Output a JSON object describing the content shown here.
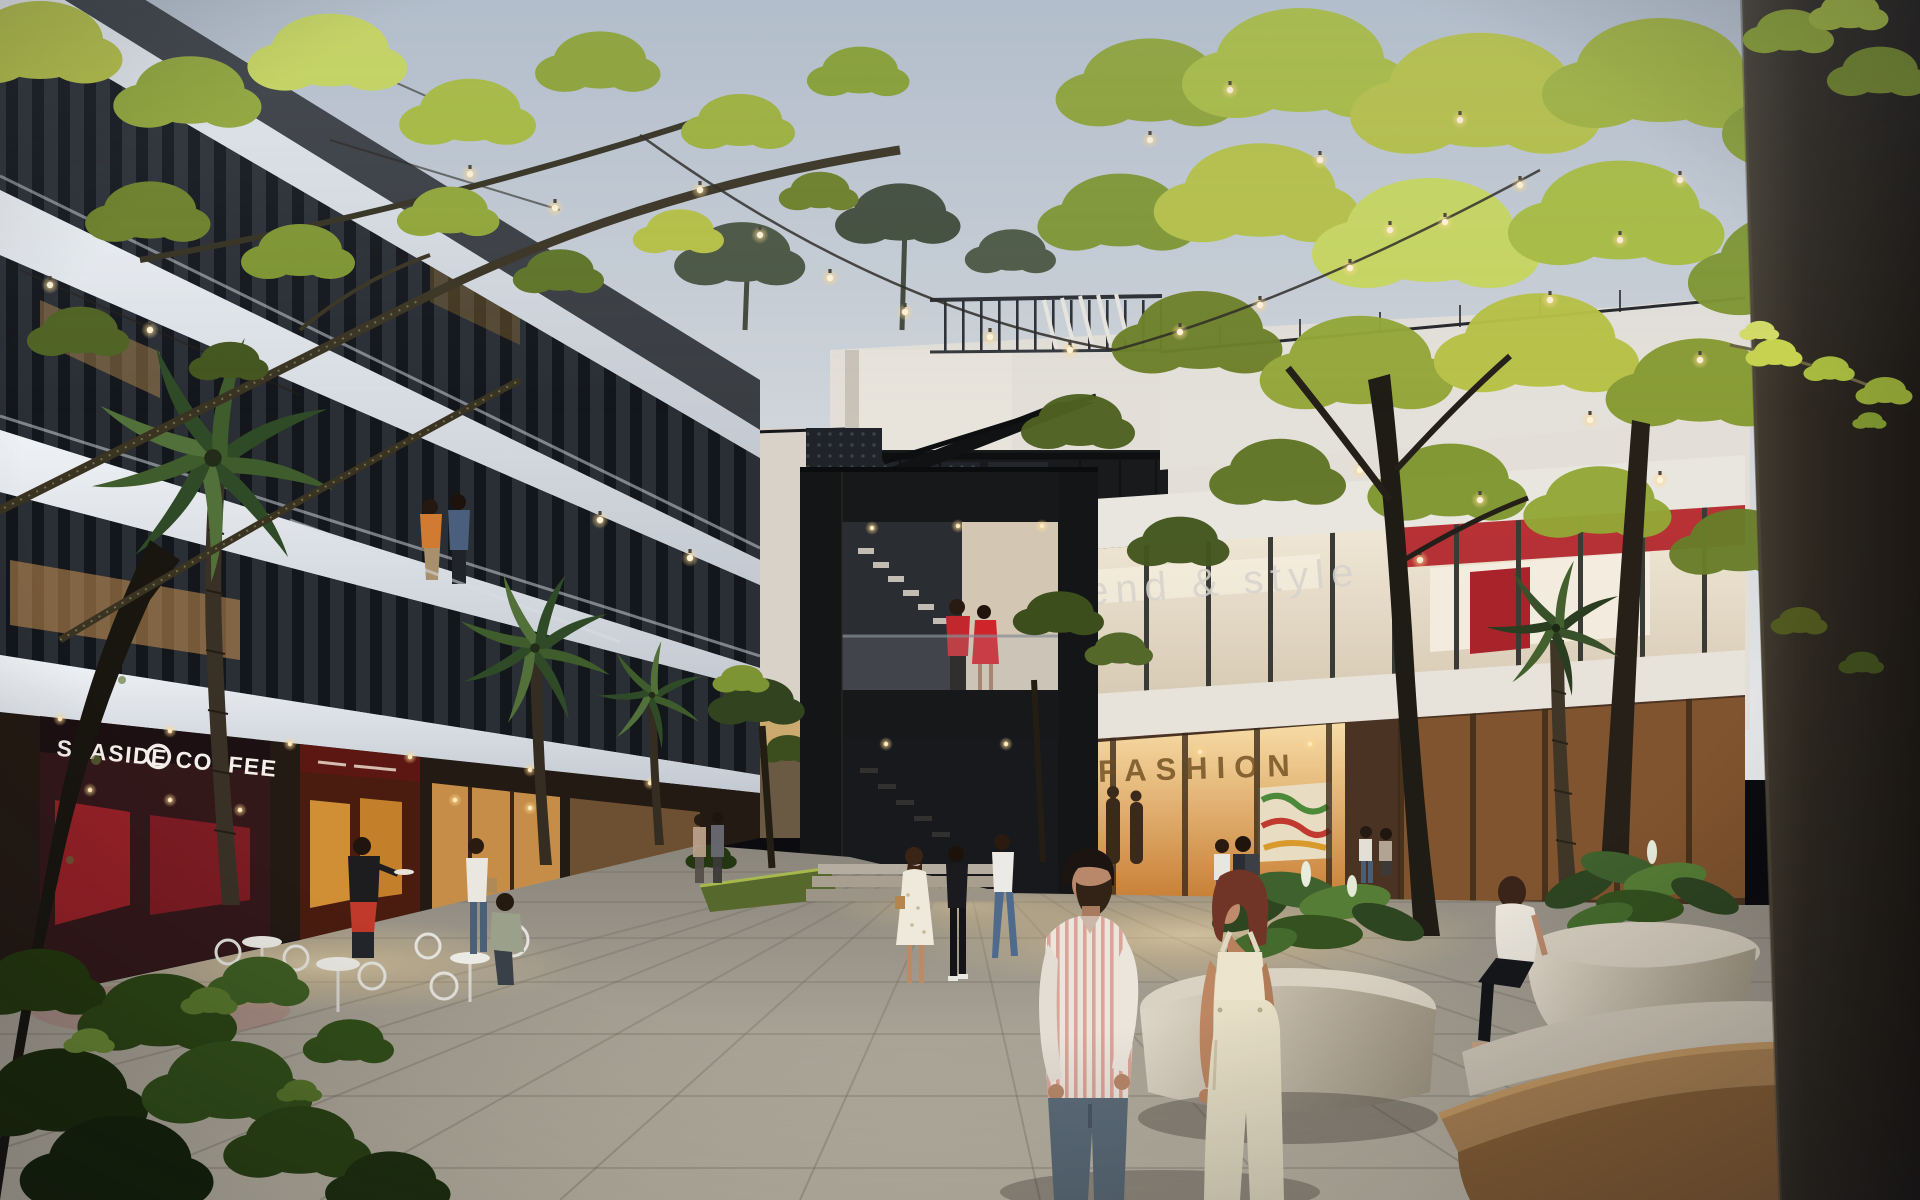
{
  "scene": {
    "type": "architectural-rendering",
    "title": "Open-air retail plaza at dusk",
    "description": "Twilight courtyard of a mixed-use development with string lights, palm trees, planter seating and warmly lit storefronts",
    "time_of_day": "dusk"
  },
  "signs": {
    "coffee_shop": "SEASIDE COFFEE",
    "upper_boutique": "trend & style",
    "fashion_store": "FASHION"
  },
  "palette": {
    "sky_top": "#b6c0cc",
    "sky_horizon": "#e4e6e8",
    "foliage_lit": "#bcc94a",
    "foliage_dark": "#31431f",
    "warm_light": "#ffd9a0",
    "red_accent": "#b5282f",
    "steel_black": "#17181a",
    "facade_white": "#e6e4df",
    "pavement": "#a8a296",
    "wood_bench": "#ad8455",
    "pillar_dark": "#2a251f"
  },
  "lighting": {
    "string_lights": "warm festoon bulbs",
    "storefront_glow": "amber",
    "sky": "overcast dusk"
  },
  "people": [
    {
      "id": "foreground-man",
      "desc": "man with beard in striped short-sleeve shirt and gray trousers"
    },
    {
      "id": "foreground-woman",
      "desc": "woman with auburn bob in cream overalls"
    },
    {
      "id": "stair-couple",
      "desc": "couple in red on staircase landing"
    },
    {
      "id": "balcony-couple",
      "desc": "couple standing at second-floor balcony"
    },
    {
      "id": "waiter",
      "desc": "waiter in black tee and red apron serving cafe tables"
    },
    {
      "id": "seated-cafe-guest",
      "desc": "man seated at white cafe table"
    },
    {
      "id": "tote-shopper",
      "desc": "woman walking with tote bag"
    },
    {
      "id": "floral-dress-woman",
      "desc": "woman in white floral dress with shoulder bag"
    },
    {
      "id": "black-outfit-woman",
      "desc": "woman in black top and leggings"
    },
    {
      "id": "white-tee-walker",
      "desc": "woman in white tee and jeans walking"
    },
    {
      "id": "fashion-shoppers",
      "desc": "shoppers with backpack outside fashion store"
    },
    {
      "id": "planter-sitter",
      "desc": "woman seated on planter edge"
    }
  ]
}
